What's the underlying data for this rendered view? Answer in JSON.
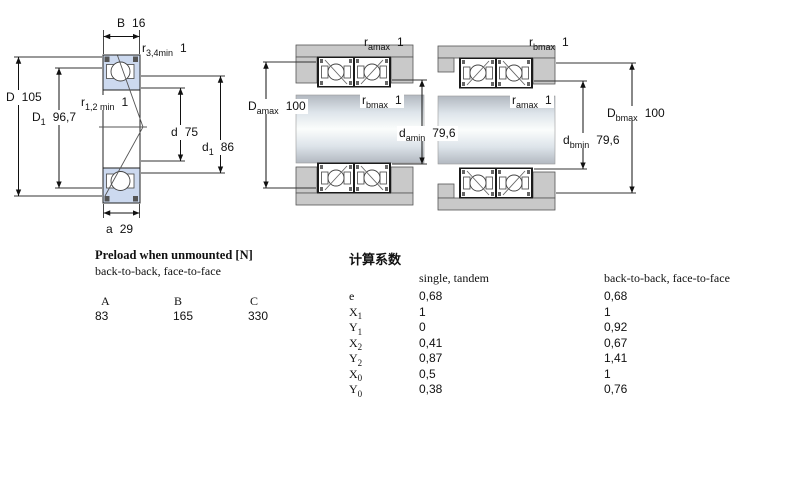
{
  "colors": {
    "bearing_fill": "#ccd9ef",
    "housing_fill": "#c9c9c9",
    "line": "#111111",
    "background": "#ffffff"
  },
  "cross_section": {
    "labels": {
      "B": {
        "base": "B",
        "sub": "",
        "value": "16"
      },
      "r34": {
        "base": "r",
        "sub": "3,4min",
        "value": "1"
      },
      "D": {
        "base": "D",
        "sub": "",
        "value": "105"
      },
      "D1": {
        "base": "D",
        "sub": "1",
        "value": "96,7"
      },
      "r12": {
        "base": "r",
        "sub": "1,2 min",
        "value": "1"
      },
      "d": {
        "base": "d",
        "sub": "",
        "value": "75"
      },
      "d1": {
        "base": "d",
        "sub": "1",
        "value": "86"
      },
      "a": {
        "base": "a",
        "sub": "",
        "value": "29"
      }
    }
  },
  "arrangement_back_to_back": {
    "labels": {
      "r_amax": {
        "base": "r",
        "sub": "amax",
        "value": "1"
      },
      "D_amax": {
        "base": "D",
        "sub": "amax",
        "value": "100"
      },
      "r_bmax": {
        "base": "r",
        "sub": "bmax",
        "value": "1"
      },
      "d_amin": {
        "base": "d",
        "sub": "amin",
        "value": "79,6"
      }
    }
  },
  "arrangement_face_to_face": {
    "labels": {
      "r_bmax": {
        "base": "r",
        "sub": "bmax",
        "value": "1"
      },
      "r_amax": {
        "base": "r",
        "sub": "amax",
        "value": "1"
      },
      "D_bmax": {
        "base": "D",
        "sub": "bmax",
        "value": "100"
      },
      "d_bmin": {
        "base": "d",
        "sub": "bmin",
        "value": "79,6"
      }
    }
  },
  "preload_table": {
    "title": "Preload when unmounted [N]",
    "subtitle": "back-to-back, face-to-face",
    "columns": [
      "A",
      "B",
      "C"
    ],
    "values": [
      "83",
      "165",
      "330"
    ]
  },
  "factors_table": {
    "title": "计算系数",
    "col1_header": "single, tandem",
    "col2_header": "back-to-back, face-to-face",
    "rows": [
      {
        "base": "e",
        "sub": "",
        "single_tandem": "0,68",
        "back_to_back": "0,68"
      },
      {
        "base": "X",
        "sub": "1",
        "single_tandem": "1",
        "back_to_back": "1"
      },
      {
        "base": "Y",
        "sub": "1",
        "single_tandem": "0",
        "back_to_back": "0,92"
      },
      {
        "base": "X",
        "sub": "2",
        "single_tandem": "0,41",
        "back_to_back": "0,67"
      },
      {
        "base": "Y",
        "sub": "2",
        "single_tandem": "0,87",
        "back_to_back": "1,41"
      },
      {
        "base": "X",
        "sub": "0",
        "single_tandem": "0,5",
        "back_to_back": "1"
      },
      {
        "base": "Y",
        "sub": "0",
        "single_tandem": "0,38",
        "back_to_back": "0,76"
      }
    ]
  }
}
